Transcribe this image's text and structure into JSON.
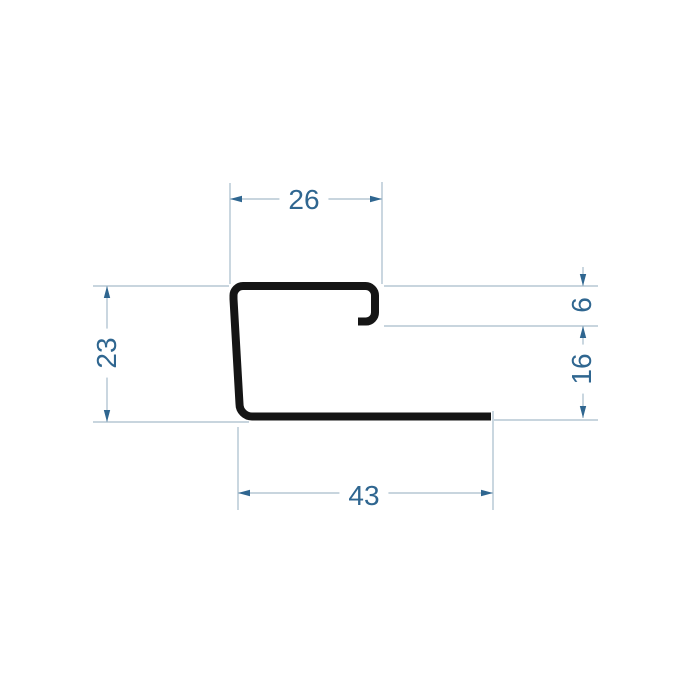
{
  "drawing": {
    "description": "Technical cross-section dimension drawing of a J-shaped trim profile"
  },
  "dimensions": {
    "top_width": "26",
    "left_height": "23",
    "lip_offset": "6",
    "right_lower_height": "16",
    "bottom_width": "43"
  },
  "colors": {
    "background": "#ffffff",
    "profile": "#151515",
    "dimension_lines": "#a6bccb",
    "dimension_text": "#2f6690"
  }
}
